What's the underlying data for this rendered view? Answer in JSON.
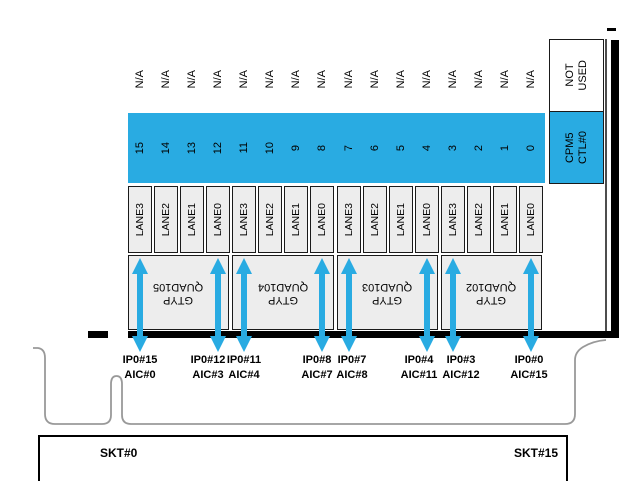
{
  "diagram": {
    "title_semantic": "CPM5 PCIe lane to socket mapping",
    "na_label": "N/A",
    "not_used": {
      "line1": "NOT",
      "line2": "USED"
    },
    "cpm5": {
      "line1": "CPM5",
      "line2": "CTL#0"
    },
    "refclk_label": "REFCLK0",
    "lanes": [
      {
        "num": "15",
        "lane": "LANE3"
      },
      {
        "num": "14",
        "lane": "LANE2"
      },
      {
        "num": "13",
        "lane": "LANE1"
      },
      {
        "num": "12",
        "lane": "LANE0"
      },
      {
        "num": "11",
        "lane": "LANE3"
      },
      {
        "num": "10",
        "lane": "LANE2"
      },
      {
        "num": "9",
        "lane": "LANE1"
      },
      {
        "num": "8",
        "lane": "LANE0"
      },
      {
        "num": "7",
        "lane": "LANE3"
      },
      {
        "num": "6",
        "lane": "LANE2"
      },
      {
        "num": "5",
        "lane": "LANE1"
      },
      {
        "num": "4",
        "lane": "LANE0"
      },
      {
        "num": "3",
        "lane": "LANE3"
      },
      {
        "num": "2",
        "lane": "LANE2"
      },
      {
        "num": "1",
        "lane": "LANE1"
      },
      {
        "num": "0",
        "lane": "LANE0"
      }
    ],
    "quads": [
      {
        "line1": "GTYP",
        "line2": "QUAD105"
      },
      {
        "line1": "GTYP",
        "line2": "QUAD104"
      },
      {
        "line1": "GTYP",
        "line2": "QUAD103"
      },
      {
        "line1": "GTYP",
        "line2": "QUAD102"
      }
    ],
    "connections": [
      {
        "ip": "IP0#15",
        "aic": "AIC#0",
        "column": 0
      },
      {
        "ip": "IP0#12",
        "aic": "AIC#3",
        "column": 3
      },
      {
        "ip": "IP0#11",
        "aic": "AIC#4",
        "column": 4
      },
      {
        "ip": "IP0#8",
        "aic": "AIC#7",
        "column": 7
      },
      {
        "ip": "IP0#7",
        "aic": "AIC#8",
        "column": 8
      },
      {
        "ip": "IP0#4",
        "aic": "AIC#11",
        "column": 11
      },
      {
        "ip": "IP0#3",
        "aic": "AIC#12",
        "column": 12
      },
      {
        "ip": "IP0#0",
        "aic": "AIC#15",
        "column": 15
      }
    ],
    "sockets": {
      "left": "SKT#0",
      "right": "SKT#15"
    },
    "colors": {
      "accent_blue": "#29ABE2",
      "box_fill": "#EDEDED",
      "outline_gray": "#999999",
      "line_black": "#000000"
    }
  }
}
